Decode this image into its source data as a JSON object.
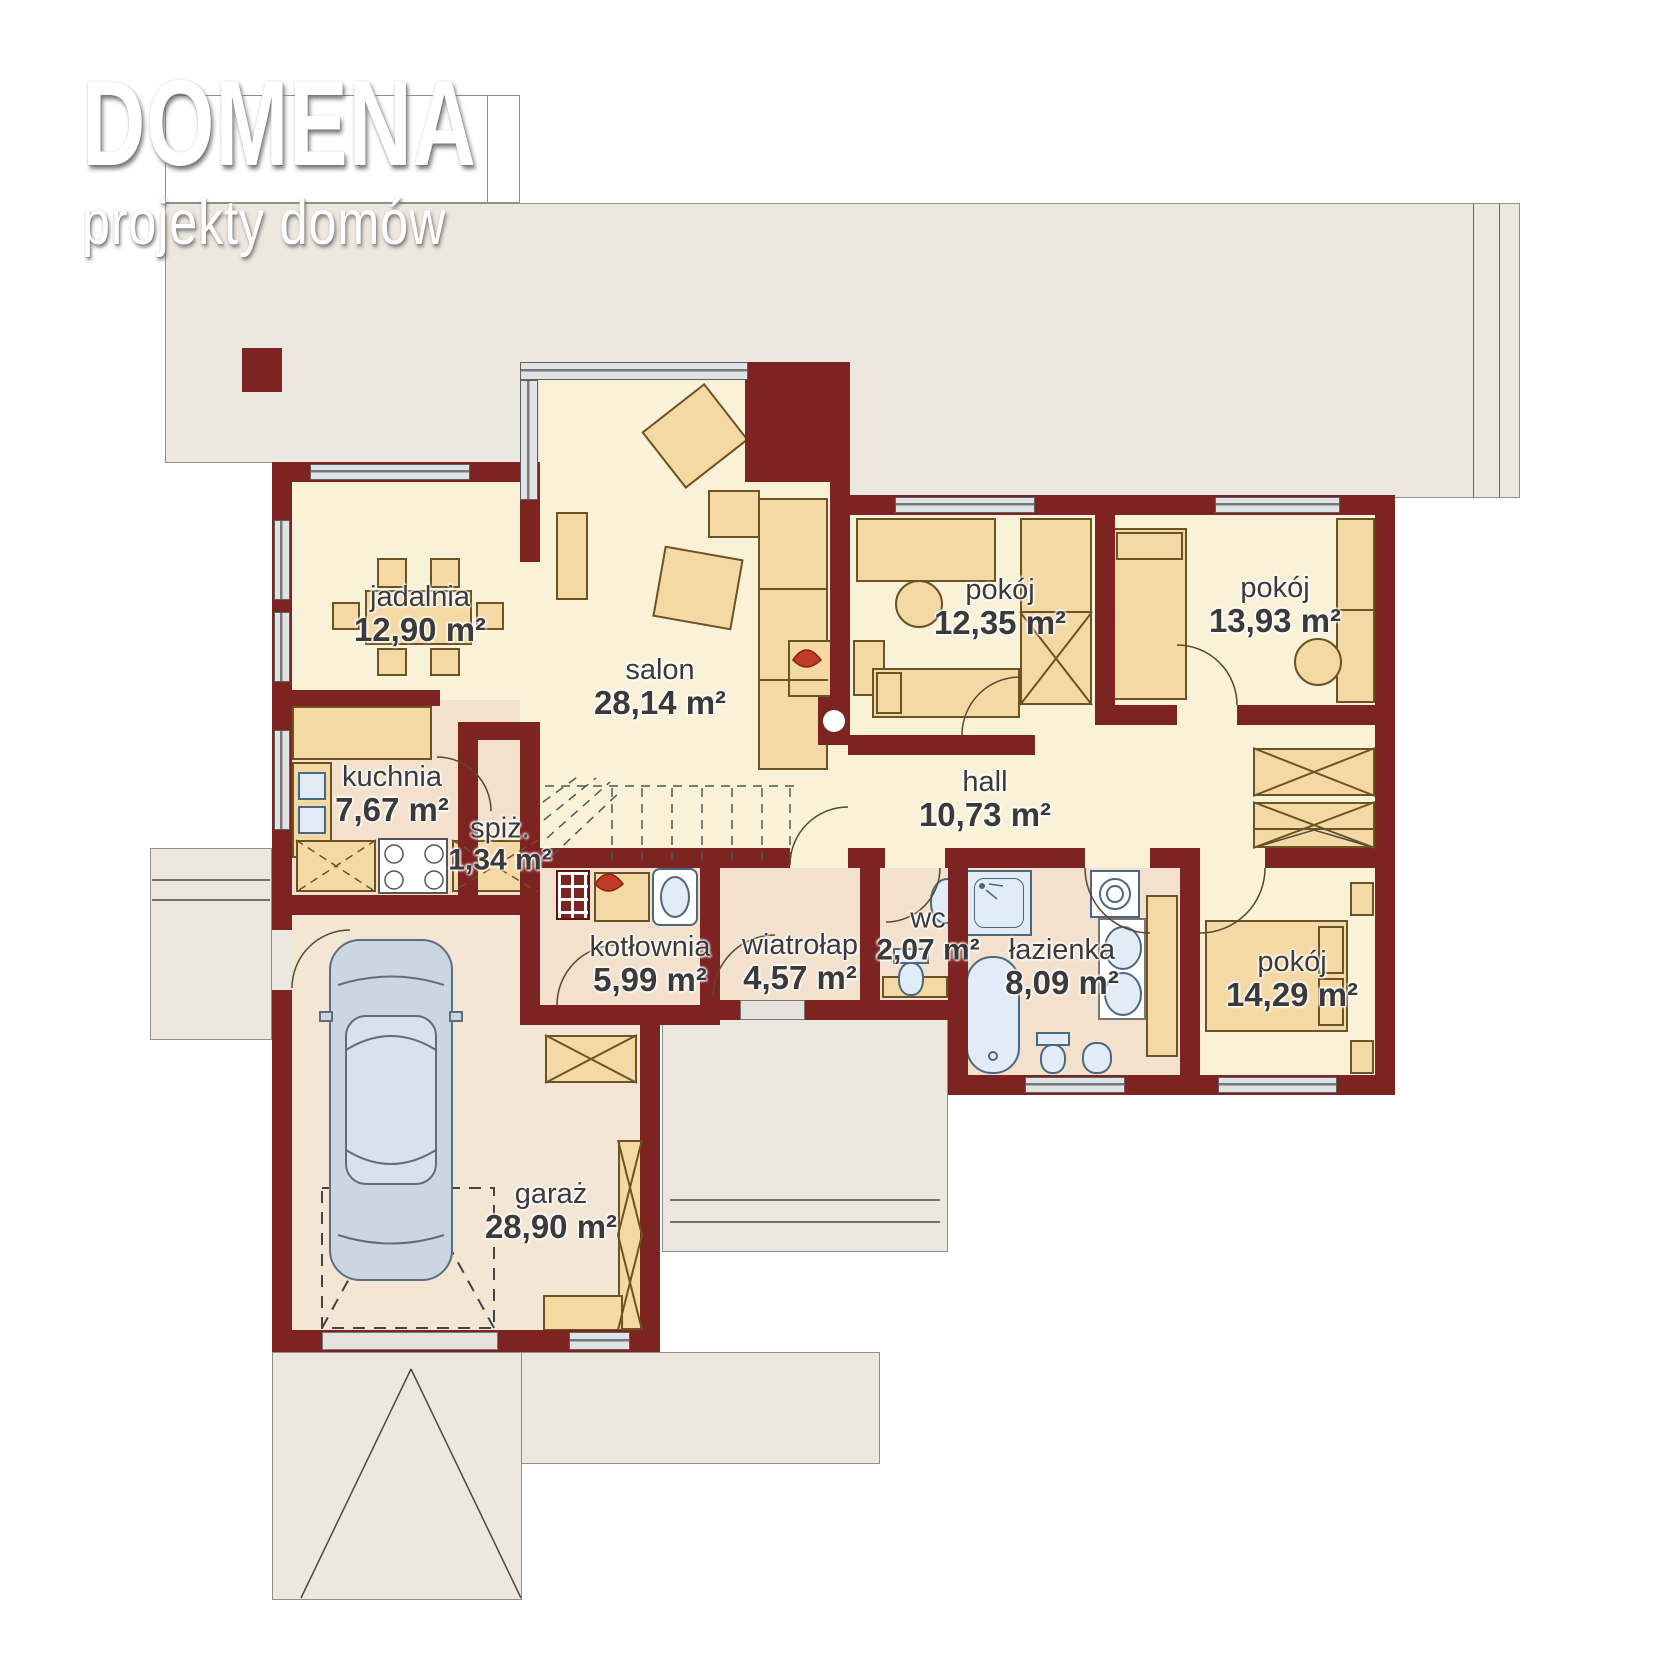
{
  "logo": {
    "title": "DOMENA",
    "subtitle": "projekty domów"
  },
  "rooms": [
    {
      "id": "jadalnia",
      "name": "jadalnia",
      "area": "12,90 m²"
    },
    {
      "id": "salon",
      "name": "salon",
      "area": "28,14 m²"
    },
    {
      "id": "pokoj-1",
      "name": "pokój",
      "area": "12,35 m²"
    },
    {
      "id": "pokoj-2",
      "name": "pokój",
      "area": "13,93 m²"
    },
    {
      "id": "kuchnia",
      "name": "kuchnia",
      "area": "7,67 m²"
    },
    {
      "id": "spizarnia",
      "name": "spiż.",
      "area": "1,34 m²"
    },
    {
      "id": "hall",
      "name": "hall",
      "area": "10,73 m²"
    },
    {
      "id": "kotlownia",
      "name": "kotłownia",
      "area": "5,99 m²"
    },
    {
      "id": "wiatrolap",
      "name": "wiatrołap",
      "area": "4,57 m²"
    },
    {
      "id": "wc",
      "name": "wc",
      "area": "2,07 m²"
    },
    {
      "id": "lazienka",
      "name": "łazienka",
      "area": "8,09 m²"
    },
    {
      "id": "pokoj-3",
      "name": "pokój",
      "area": "14,29 m²"
    },
    {
      "id": "garaz",
      "name": "garaż",
      "area": "28,90 m²"
    }
  ],
  "colors": {
    "wall": "#7d2322",
    "room_cream": "#f9f2d8",
    "room_peach": "#f3e1ce",
    "room_garage": "#f4e6d4",
    "outdoor": "#ece7df",
    "furniture": "#f4d9a5",
    "fixture": "#e1ecf6",
    "window": "#dfe3e6"
  }
}
